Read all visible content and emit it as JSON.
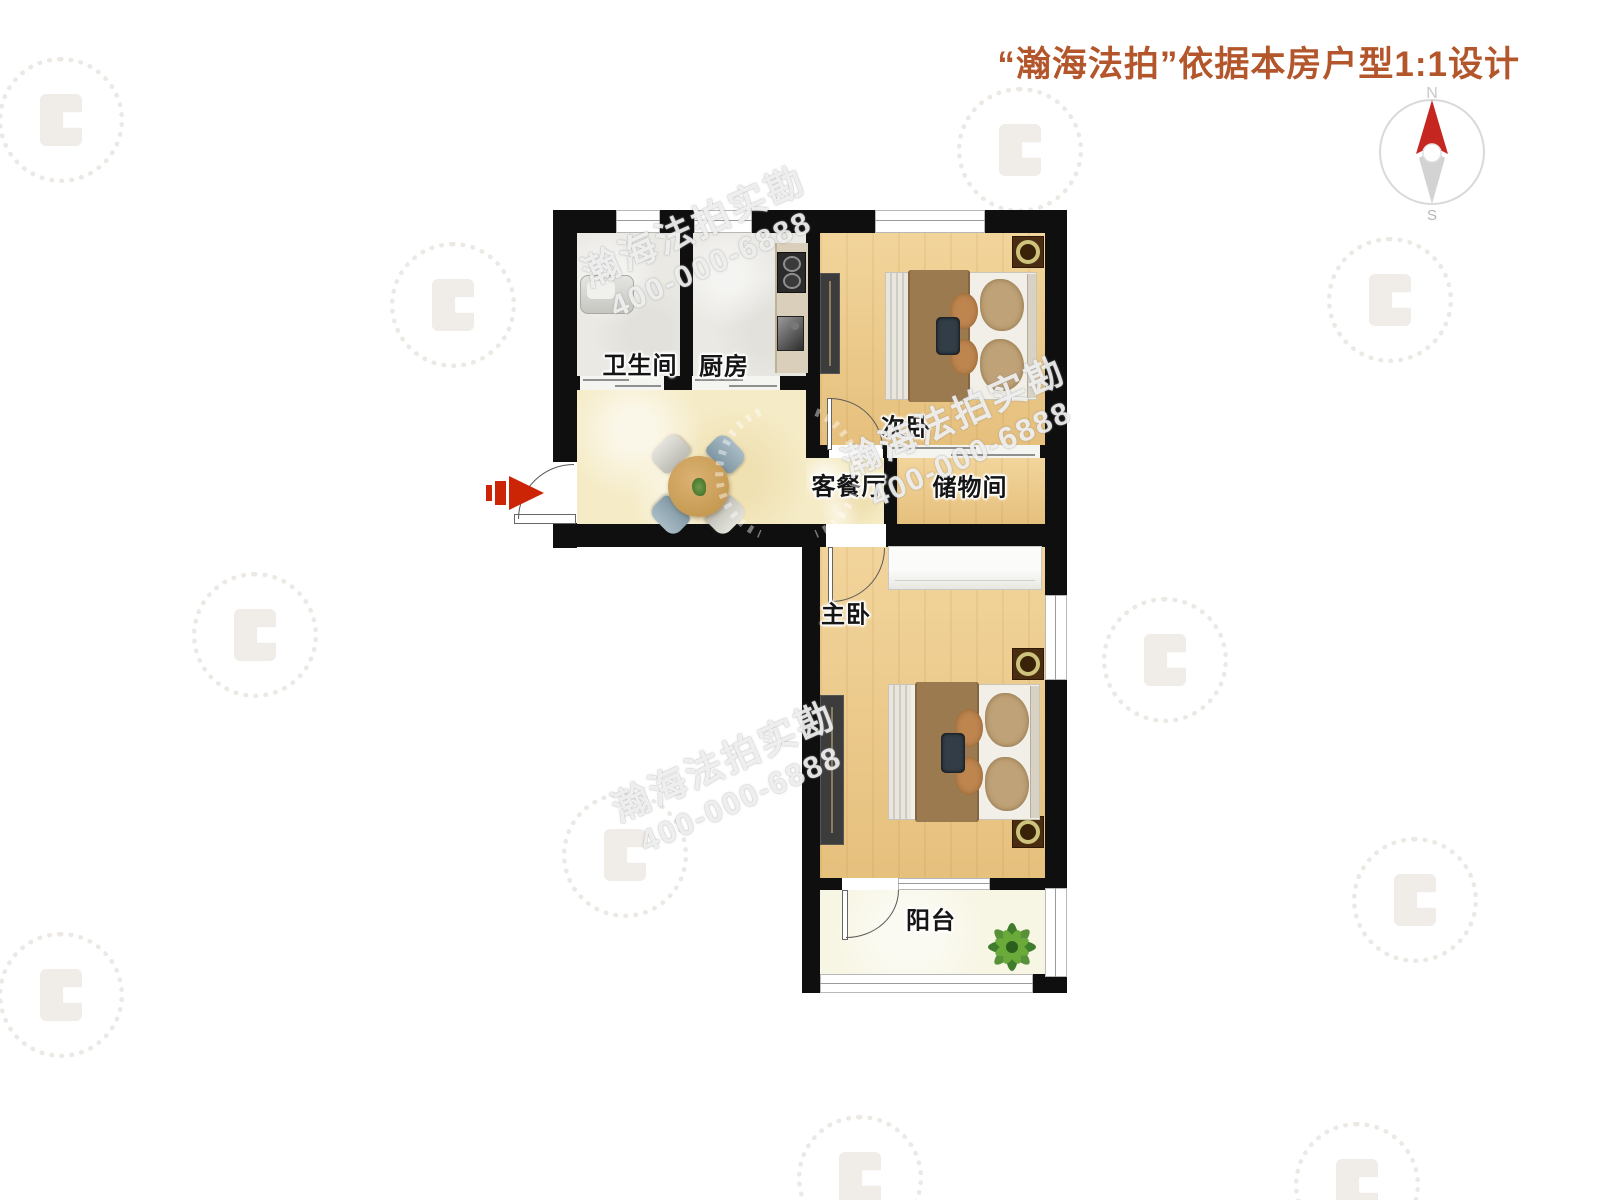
{
  "header": {
    "title": "“瀚海法拍”依据本房户型1:1设计",
    "title_color": "#b4562c"
  },
  "compass": {
    "north": "N",
    "south": "S",
    "north_needle_color": "#c52620",
    "south_needle_color": "#d3d3d3"
  },
  "rooms": {
    "bathroom": {
      "label": "卫生间"
    },
    "kitchen": {
      "label": "厨房"
    },
    "second_bedroom": {
      "label": "次卧"
    },
    "storage": {
      "label": "储物间"
    },
    "living_dining": {
      "label": "客餐厅"
    },
    "master_bedroom": {
      "label": "主卧"
    },
    "balcony": {
      "label": "阳台"
    }
  },
  "watermark": {
    "brand": "瀚海法拍实勘",
    "phone": "400-000-6888"
  },
  "entrance": {
    "arrow_color": "#cc2505"
  },
  "palette": {
    "wall": "#0f0f0f",
    "wood_floor": "#ebc989",
    "living_floor": "#f5ebc6",
    "tile_floor": "#eae9e4",
    "balcony_floor": "#f7f5e3"
  }
}
